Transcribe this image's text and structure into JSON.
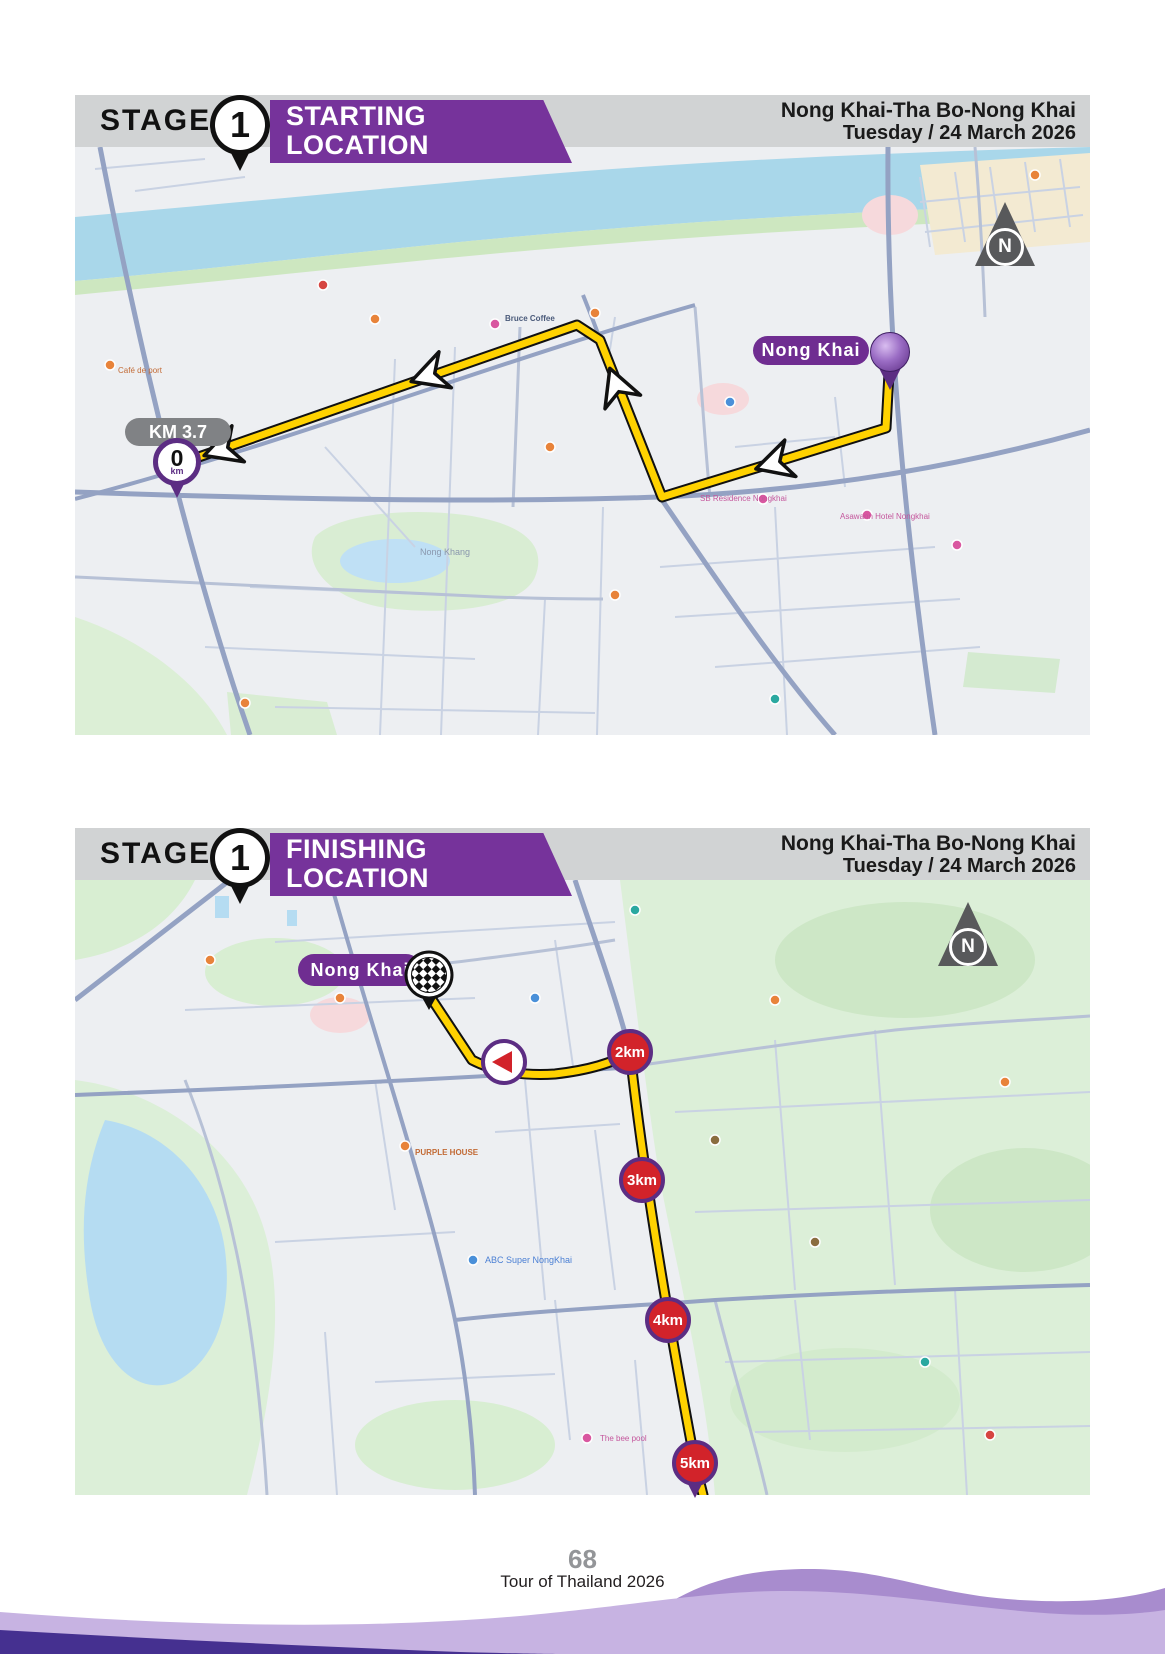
{
  "page": {
    "number": "68",
    "footer_title": "Tour of Thailand 2026"
  },
  "stage": {
    "label": "STAGE",
    "number": "1",
    "race_title": "Nong Khai-Tha Bo-Nong Khai",
    "race_date": "Tuesday / 24 March 2026"
  },
  "start_map": {
    "banner_line1": "STARTING",
    "banner_line2": "LOCATION",
    "city_label": "Nong Khai",
    "neutral_km_label": "KM 3.7",
    "zero_marker": {
      "value": "0",
      "unit": "km"
    },
    "north_label": "N",
    "poi_labels": [
      "Bruce Coffee",
      "Café de port",
      "Nong Khang",
      "SB Residence Nongkhai",
      "Asawann Hotel Nongkhai"
    ]
  },
  "finish_map": {
    "banner_line1": "FINISHING",
    "banner_line2": "LOCATION",
    "city_label": "Nong Khai",
    "km_markers": [
      "2km",
      "3km",
      "4km",
      "5km"
    ],
    "north_label": "N",
    "poi_labels": [
      "PURPLE HOUSE",
      "ABC Super NongKhai",
      "The bee pool"
    ]
  },
  "colors": {
    "banner_purple": "#76339b",
    "pill_purple": "#6f2d91",
    "header_gray": "#d1d3d4",
    "route_yellow": "#ffd200",
    "km_marker_red": "#d2232a",
    "marker_ring_purple": "#5c2d83",
    "water_blue": "#a9d7ea",
    "park_green": "#d9edd3",
    "page_number_gray": "#939598"
  }
}
